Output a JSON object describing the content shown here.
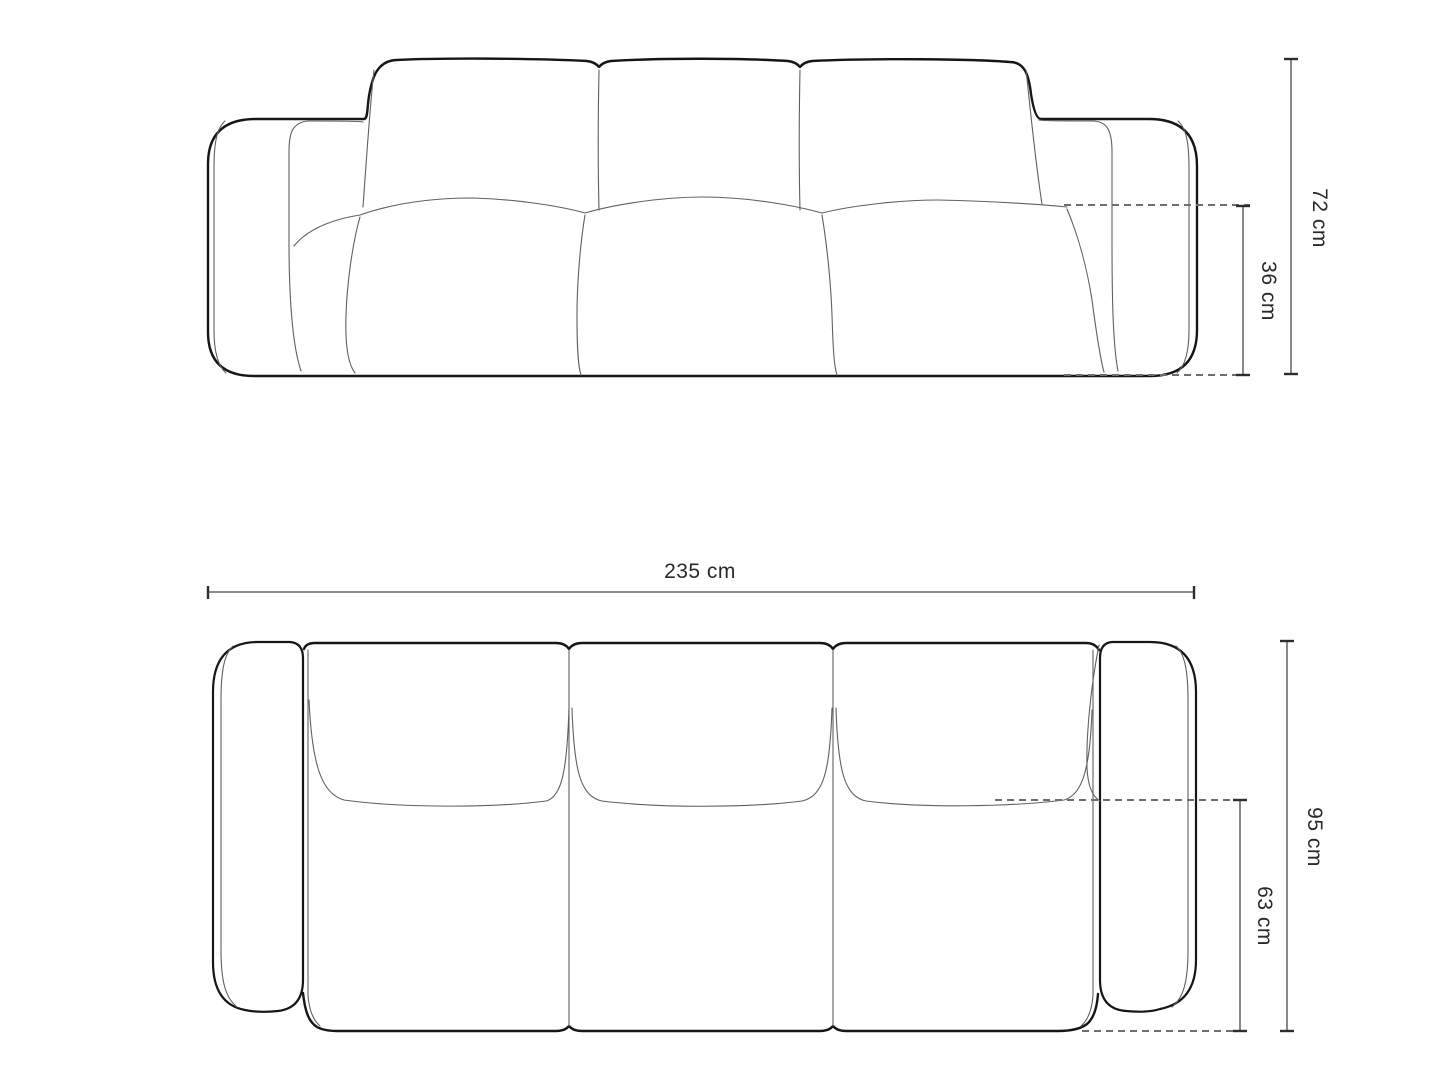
{
  "diagram": {
    "subject": "sofa-technical-dimension-drawing",
    "colors": {
      "background": "#ffffff",
      "outline": "#161616",
      "contour": "#606060",
      "dimension_line": "#7c7c7c",
      "dashed_extension": "#6e6e6e",
      "tick": "#2d2d2d",
      "label_text": "#2a2a2a"
    },
    "front_view": {
      "name": "front elevation",
      "height_label": "72 cm",
      "seat_height_label": "36 cm"
    },
    "top_view": {
      "name": "top plan",
      "width_label": "235 cm",
      "depth_label": "95 cm",
      "seat_depth_label": "63 cm"
    }
  }
}
